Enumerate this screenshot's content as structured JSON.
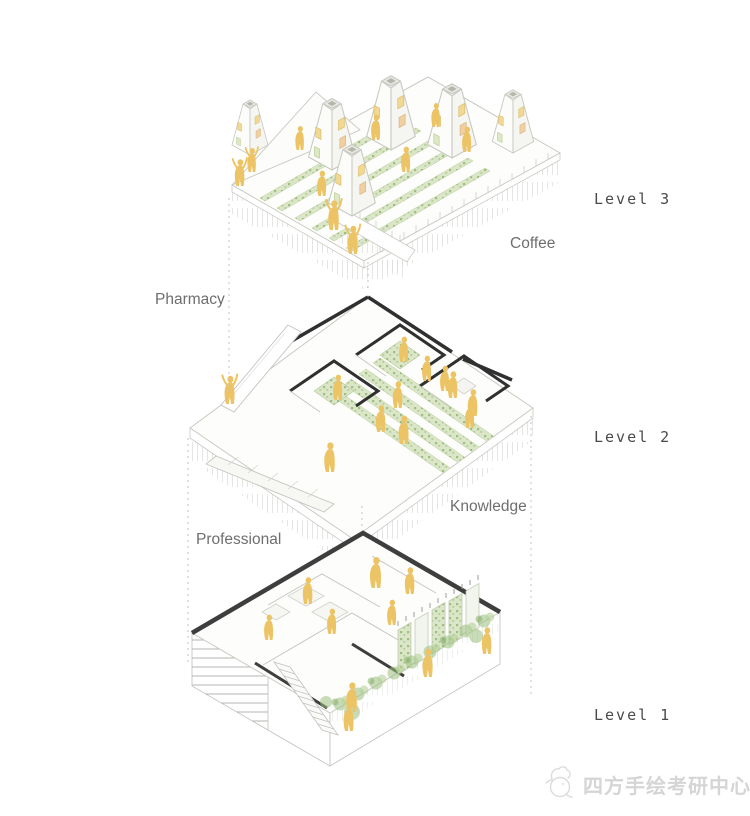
{
  "diagram": {
    "type": "exploded-axonometric-building-diagram",
    "levels": [
      {
        "tag": "Level 3",
        "zone": "Coffee"
      },
      {
        "tag": "Level 2",
        "zones": [
          "Pharmacy",
          "Knowledge"
        ]
      },
      {
        "tag": "Level 1",
        "zone": "Professional"
      }
    ]
  },
  "annotations": {
    "level3": "Level 3",
    "level2": "Level 2",
    "level1": "Level 1",
    "coffee": "Coffee",
    "pharmacy": "Pharmacy",
    "knowledge": "Knowledge",
    "professional": "Professional"
  },
  "watermark": {
    "text": "四方手绘考研中心",
    "logo_icon": "sketch-rooster-logo"
  },
  "colors": {
    "figure_yellow": "#edc465",
    "vegetation_light": "#dbe6c8",
    "vegetation_dark": "#9fbe7f",
    "wall_black": "#303030",
    "roof_edge_dark": "#3e3e3e",
    "line_gray": "#c8c8c2",
    "label_mono": "#4a4a4a",
    "label_sans": "#6e6e6e",
    "watermark_gray": "#d5d5d5"
  }
}
